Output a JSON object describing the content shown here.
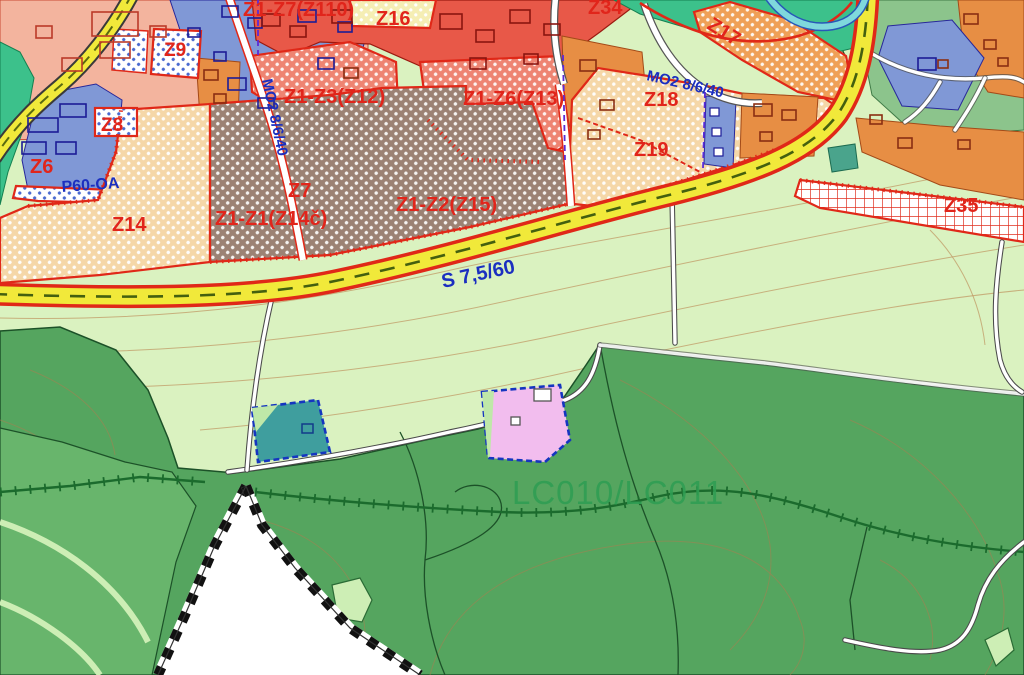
{
  "map": {
    "labels": {
      "z6": "Z6",
      "z7": "Z7",
      "z8": "Z8",
      "z9": "Z9",
      "z14": "Z14",
      "z16": "Z16",
      "z17": "Z17",
      "z18": "Z18",
      "z19": "Z19",
      "z34": "Z34",
      "z35": "Z35",
      "z14c": "Z1-Z1(Z14č)",
      "z15": "Z1-Z2(Z15)",
      "z12": "Z1-Z3(Z12)",
      "z13": "Z1-Z6(Z13)",
      "z110": "Z1-Z7(Z110)",
      "p60": "P60-OA",
      "mo2_vertical": "MO2 8/6/40",
      "mo2_diagonal": "MO2 8/6/40",
      "s_road": "S 7,5/60",
      "lc": "LC010/LC011"
    },
    "colors": {
      "meadow": "#daf2c0",
      "forest": "#55a55f",
      "mid_green": "#68b56c",
      "zone_label_red": "#e1251b",
      "road_label_blue": "#1b2fc0",
      "lc_label_green": "#2f9e53",
      "road_yellow": "#f1e93a",
      "boundary_red": "#e02818",
      "tan_zone": "#f5d7a8",
      "brown_zone": "#9c8274",
      "salmon_zone": "#f3b49e",
      "red_zone": "#e85848",
      "red_hatch_zone": "#ee8472",
      "orange_zone": "#e78e44",
      "blue_zone": "#8098d6",
      "cream_zone": "#f5eeb4",
      "green_park": "#3cc18b",
      "sage_zone": "#8cc48c",
      "water": "#7fd8dc",
      "teal_parcel": "#3f9e9e",
      "pink_parcel": "#f2bdee",
      "parcel_border_blue": "#1535c0",
      "outside_area": "#ffffff"
    }
  }
}
